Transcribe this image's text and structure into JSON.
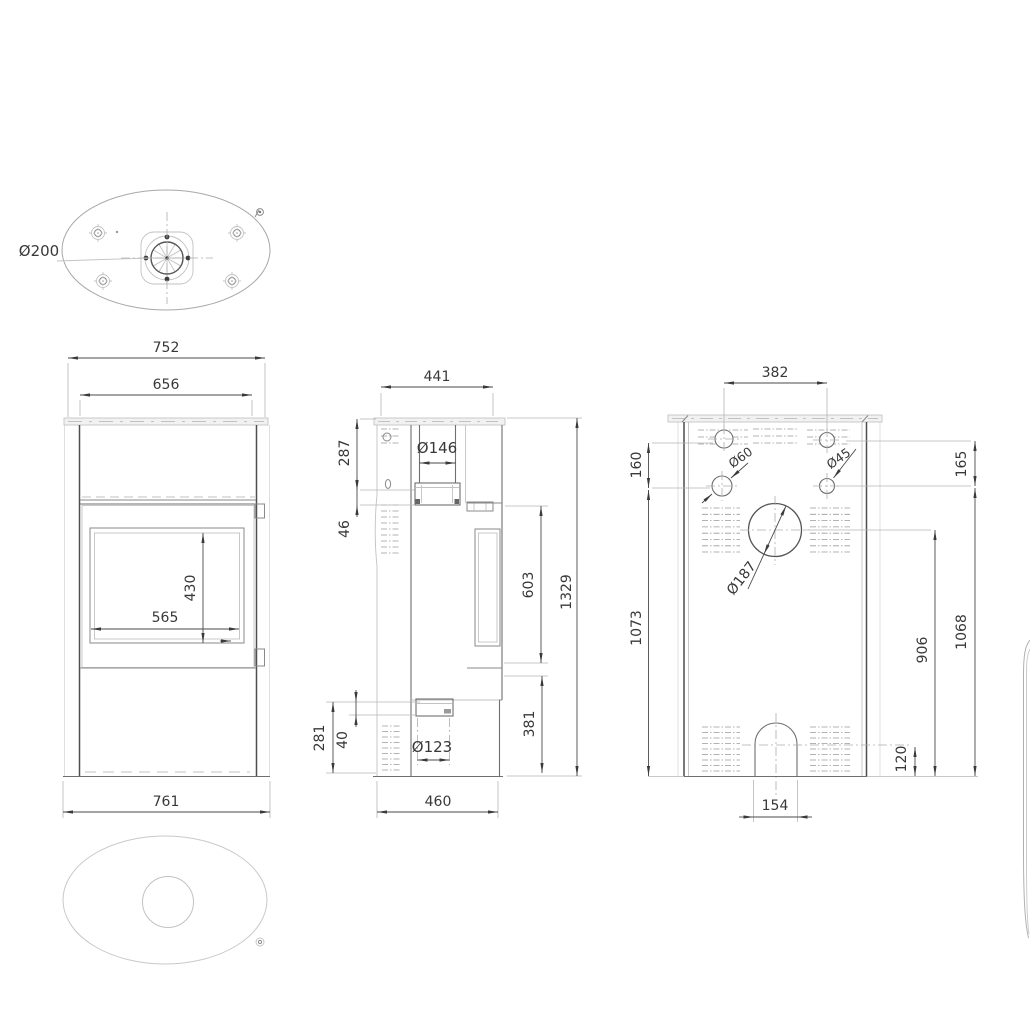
{
  "document": {
    "type": "technical-dimension-drawing",
    "subject": "oval wood-burning stove, four orthographic views"
  },
  "colors": {
    "background": "#ffffff",
    "line_dark": "#4f4f4f",
    "line_light": "#c2c2c2",
    "dimension_text": "#383838",
    "top_plate_fill": "#f1f1f1"
  },
  "top_view": {
    "flue_diameter_label": "Ø200"
  },
  "front_view": {
    "dim_top_width": "752",
    "dim_inner_width": "656",
    "dim_glass_height": "430",
    "dim_glass_width": "565",
    "dim_base_width": "761"
  },
  "side_view": {
    "dim_depth": "441",
    "dim_flue_offset": "287",
    "dim_collar_height": "46",
    "dim_flue_pipe_diameter": "Ø146",
    "dim_door_height": "603",
    "dim_total_height": "1329",
    "dim_lower_height": "381",
    "dim_intake_offset": "281",
    "dim_intake_height": "40",
    "dim_intake_diameter": "Ø123",
    "dim_base_depth": "460"
  },
  "rear_view": {
    "dim_hole_spacing": "382",
    "dim_left_hole_offset": "160",
    "dim_left_hole_diameter": "Ø60",
    "dim_right_hole_diameter": "Ø45",
    "dim_right_hole_offset": "165",
    "dim_flue_diameter": "Ø187",
    "dim_left_height": "1073",
    "dim_flue_center_height": "906",
    "dim_right_height": "1068",
    "dim_arch_height": "120",
    "dim_arch_width": "154"
  }
}
